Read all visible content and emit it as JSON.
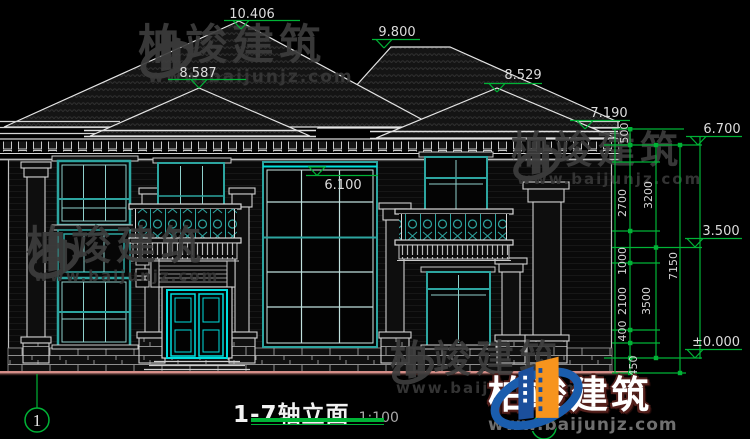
{
  "title": {
    "text": "1-7轴立面",
    "scale": "1:100"
  },
  "axis": {
    "left_bubble": "1"
  },
  "markers": {
    "m10406": "10.406",
    "m9800": "9.800",
    "m8587": "8.587",
    "m8529": "8.529",
    "m7190": "7.190",
    "m6700": "6.700",
    "m6100": "6.100",
    "m3500": "3.500",
    "m0": "±0.000"
  },
  "dims": {
    "d500": "500",
    "d2700": "2700",
    "d1000": "1000",
    "d2100": "2100",
    "d400": "400",
    "d450": "450",
    "d3200": "3200",
    "d3500": "3500",
    "d7150": "7150"
  },
  "watermark": {
    "brand": "柏竣建筑",
    "url": "www.baijunjz.com"
  },
  "footer_logo": {
    "brand": "柏竣建筑",
    "url": "www.baijunjz.com"
  },
  "colors": {
    "annotation_green": "#00b336",
    "window_teal": "#2da5a0",
    "door_cyan": "#00dede",
    "ground_pink": "#d48e88",
    "logo_blue": "#1a5dad",
    "logo_orange": "#f7941d"
  }
}
